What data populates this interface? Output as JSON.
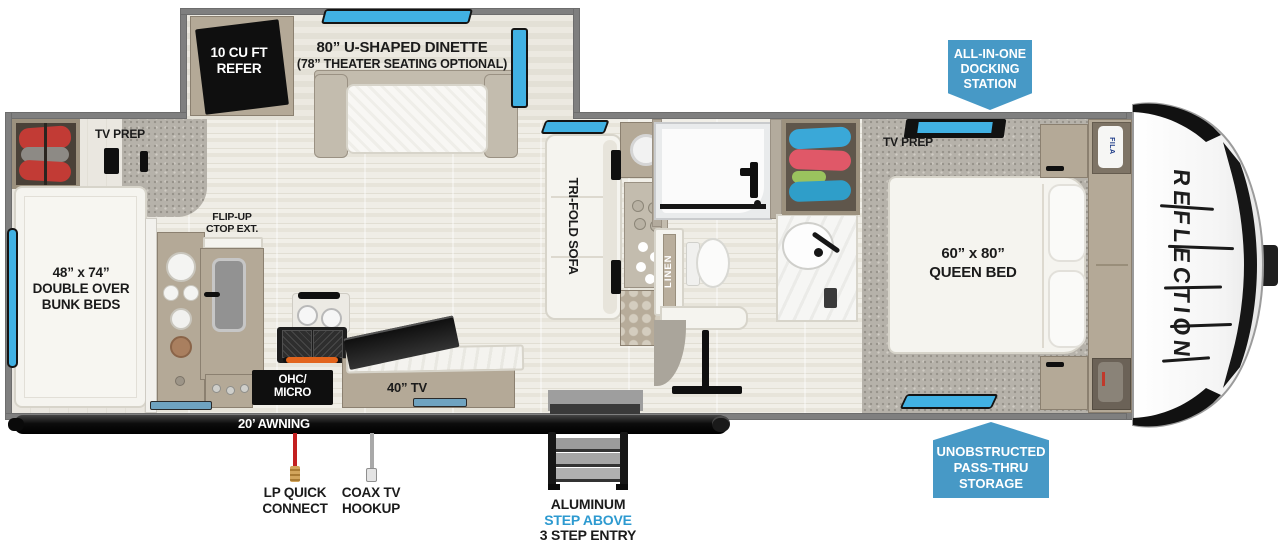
{
  "plan": {
    "slide": {
      "refer_l1": "10 CU FT",
      "refer_l2": "REFER",
      "dinette_l1": "80” U-SHAPED DINETTE",
      "dinette_l2": "(78” THEATER SEATING OPTIONAL)"
    },
    "bunk_room": {
      "tv_prep": "TV PREP",
      "bunk_l1": "48” x 74”",
      "bunk_l2": "DOUBLE OVER",
      "bunk_l3": "BUNK BEDS"
    },
    "kitchen": {
      "flip_l1": "FLIP-UP",
      "flip_l2": "CTOP EXT.",
      "ohc_l1": "OHC/",
      "ohc_l2": "MICRO",
      "tv": "40” TV"
    },
    "living": {
      "sofa": "TRI-FOLD SOFA"
    },
    "bath": {
      "linen": "LINEN"
    },
    "bedroom": {
      "tv_prep": "TV PREP",
      "bed_l1": "60” x 80”",
      "bed_l2": "QUEEN BED",
      "shirt_tag": "FILA"
    },
    "front": {
      "logo": "REFLECTION"
    }
  },
  "callouts": {
    "docking": {
      "l1": "ALL-IN-ONE",
      "l2": "DOCKING",
      "l3": "STATION"
    },
    "passthru": {
      "l1": "UNOBSTRUCTED",
      "l2": "PASS-THRU",
      "l3": "STORAGE"
    },
    "awning": "20’ AWNING",
    "lp": {
      "l1": "LP QUICK",
      "l2": "CONNECT"
    },
    "coax": {
      "l1": "COAX TV",
      "l2": "HOOKUP"
    },
    "entry": {
      "l1": "ALUMINUM",
      "l2": "STEP ABOVE",
      "l3": "3 STEP ENTRY"
    }
  },
  "colors": {
    "badge_blue": "#4799c6",
    "entry_step_blue": "#2d9ad0",
    "window_blue": "#41b1e3",
    "lp_red": "#c32020"
  }
}
